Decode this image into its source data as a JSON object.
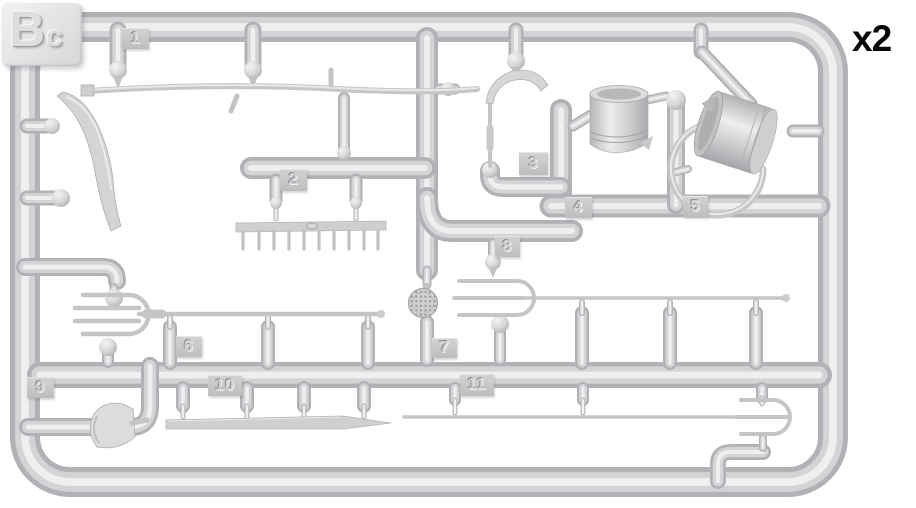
{
  "sprue": {
    "code": "Bc",
    "quantity_note": "x2",
    "tags": [
      "1",
      "2",
      "3",
      "4",
      "5",
      "6",
      "7",
      "8",
      "9",
      "10",
      "11"
    ]
  },
  "colors": {
    "background": "#ffffff",
    "plastic_base": "#d4d4d7",
    "plastic_shadow": "#b2b2b6",
    "plastic_highlight": "#eeeef0",
    "tag_plate": "#c8c8cb",
    "quantity_text": "#070707"
  }
}
